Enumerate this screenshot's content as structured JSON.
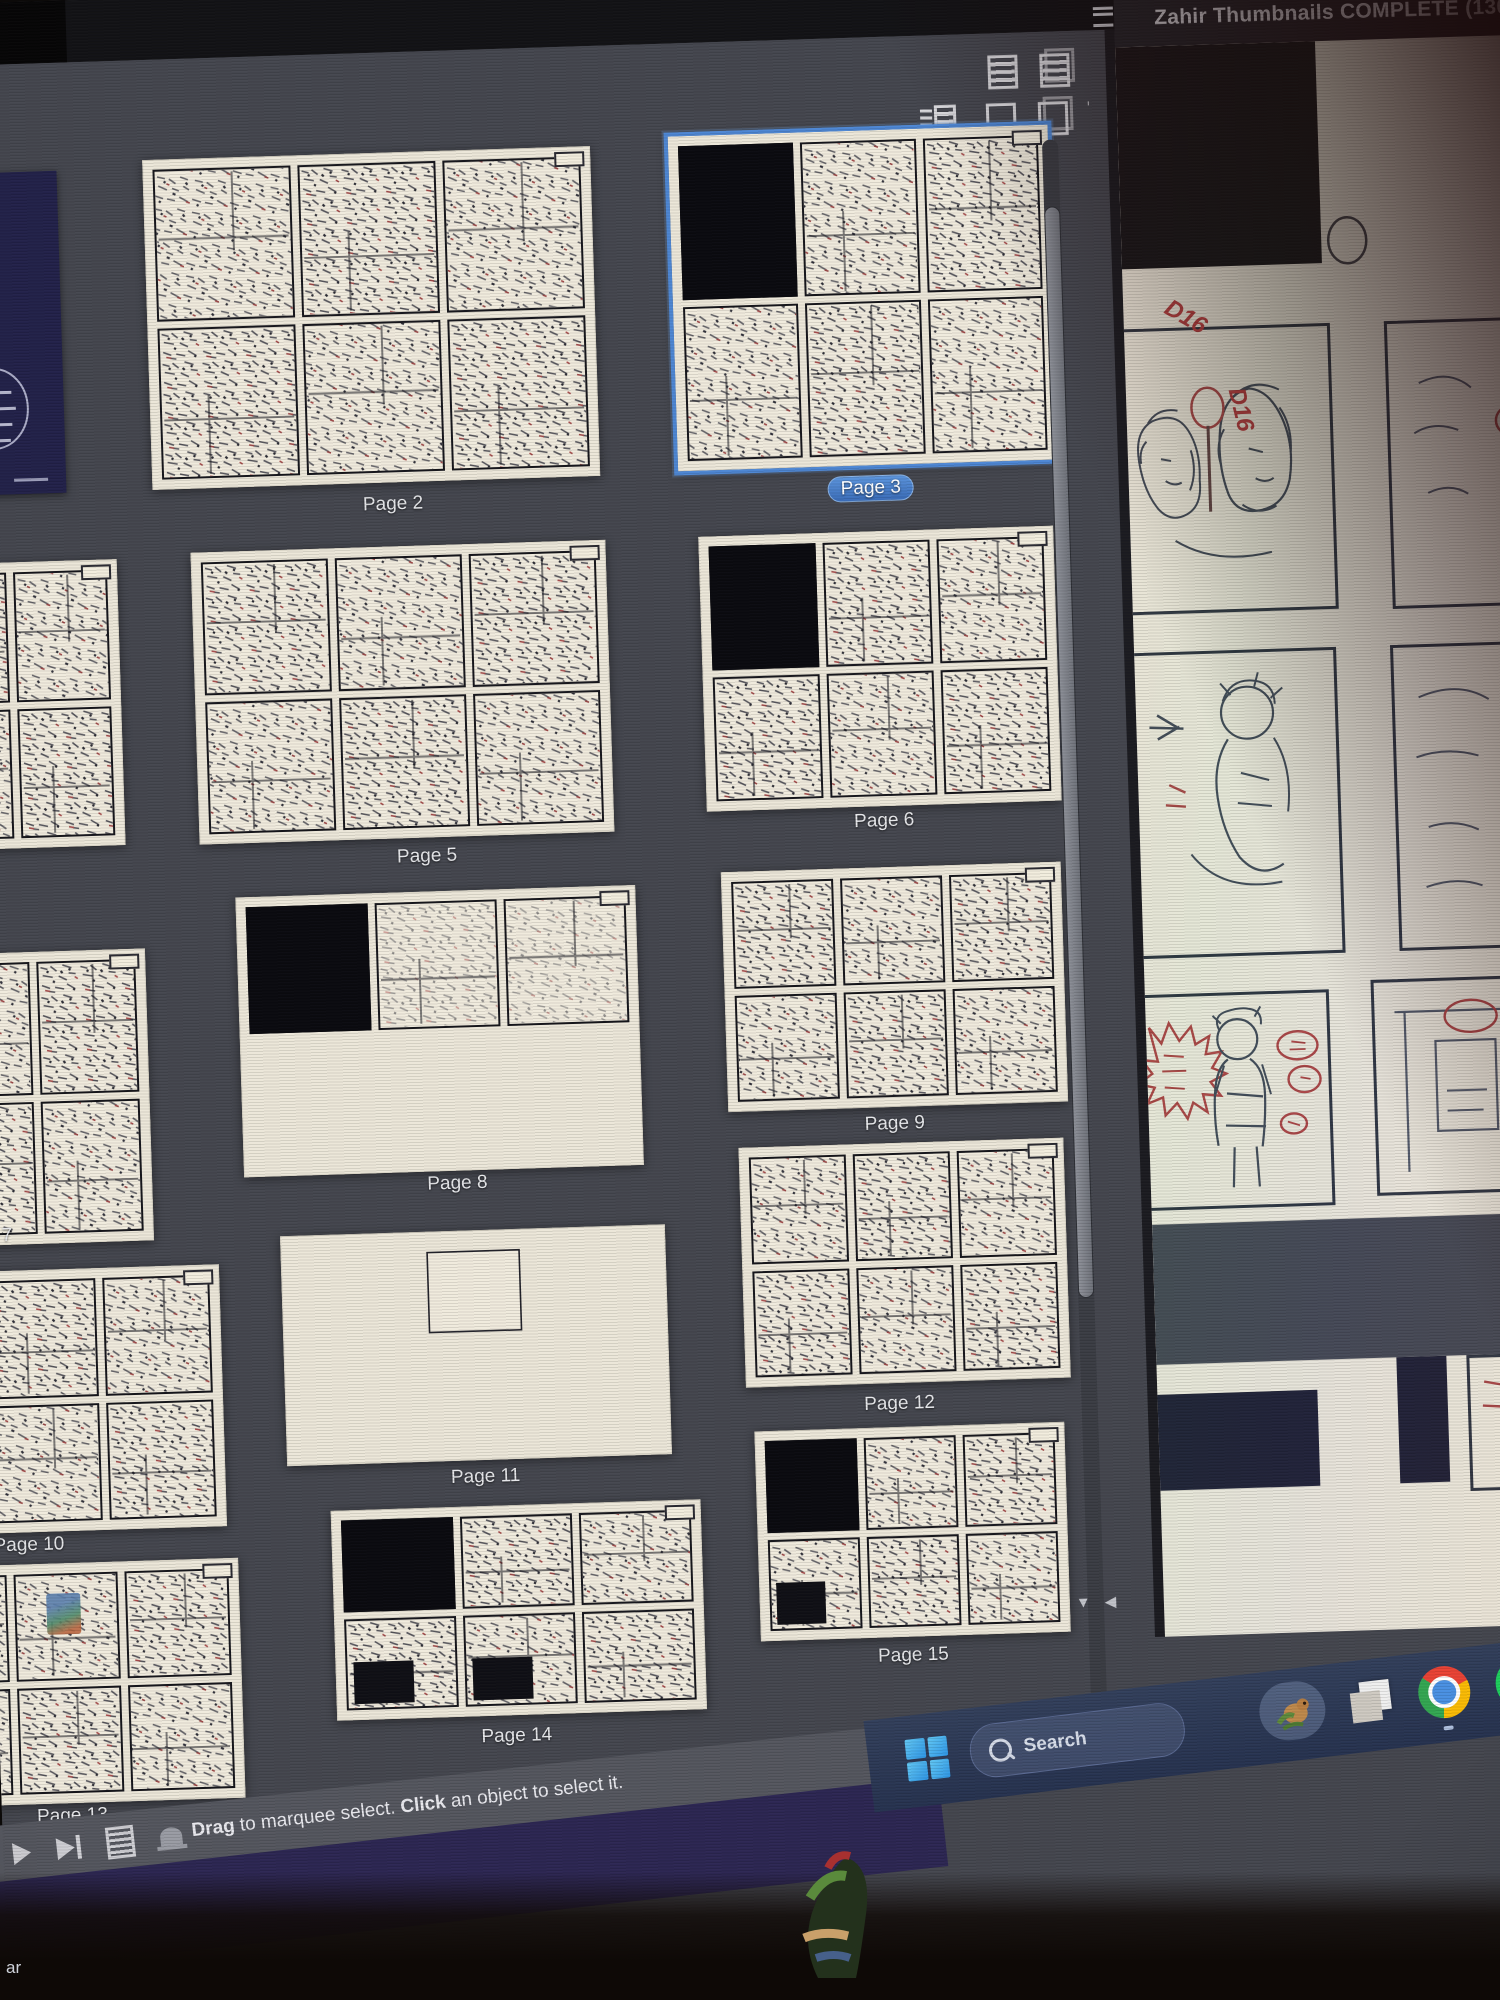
{
  "right_window": {
    "title": "Zahir Thumbnails COMPLETE (130",
    "annotations": {
      "a": "D16",
      "b": "D16"
    },
    "icons": [
      "panel-menu-icon"
    ]
  },
  "thumbnail_panel": {
    "toolbar_row1_icons": [
      "page-info-view-icon",
      "spread-info-view-icon",
      "page-small-view-icon"
    ],
    "toolbar_row2_icons": [
      "detail-list-view-icon",
      "single-page-view-icon",
      "facing-pages-view-icon",
      "delete-page-icon"
    ],
    "scrollbar": [
      "vertical-scrollbar",
      "scroll-down-arrow",
      "scroll-left-arrow"
    ],
    "pages": [
      {
        "id": "p1",
        "label": "",
        "variant": "cover",
        "selected": false
      },
      {
        "id": "p4",
        "label": "",
        "variant": "full",
        "selected": false
      },
      {
        "id": "p7",
        "label": "e 7",
        "variant": "full",
        "selected": false
      },
      {
        "id": "p10",
        "label": "Page 10",
        "variant": "full",
        "selected": false
      },
      {
        "id": "p13",
        "label": "Page 13",
        "variant": "fullc",
        "selected": false
      },
      {
        "id": "p2",
        "label": "Page 2",
        "variant": "full",
        "selected": false
      },
      {
        "id": "p5",
        "label": "Page 5",
        "variant": "full",
        "selected": false
      },
      {
        "id": "p8",
        "label": "Page 8",
        "variant": "sparse",
        "selected": false
      },
      {
        "id": "p11",
        "label": "Page 11",
        "variant": "one",
        "selected": false
      },
      {
        "id": "p14",
        "label": "Page 14",
        "variant": "dark",
        "selected": false
      },
      {
        "id": "p3",
        "label": "Page 3",
        "variant": "bf",
        "selected": true
      },
      {
        "id": "p6",
        "label": "Page 6",
        "variant": "bf",
        "selected": false
      },
      {
        "id": "p9",
        "label": "Page 9",
        "variant": "full",
        "selected": false
      },
      {
        "id": "p12",
        "label": "Page 12",
        "variant": "full",
        "selected": false
      },
      {
        "id": "p15",
        "label": "Page 15",
        "variant": "dark15",
        "selected": false
      }
    ]
  },
  "status_bar": {
    "icons": [
      "play-icon",
      "skip-end-icon",
      "notes-icon",
      "bell-icon"
    ],
    "drag": "Drag",
    "mid": " to marquee select. ",
    "click": "Click",
    "rest": " an object to select it."
  },
  "taskbar": {
    "search_label": "Search",
    "icons": [
      "start-button",
      "search-pill",
      "pet-icon",
      "app-window-icon",
      "chrome-icon",
      "spotify-icon"
    ]
  },
  "misc": {
    "bottom_left_text": "ar"
  }
}
